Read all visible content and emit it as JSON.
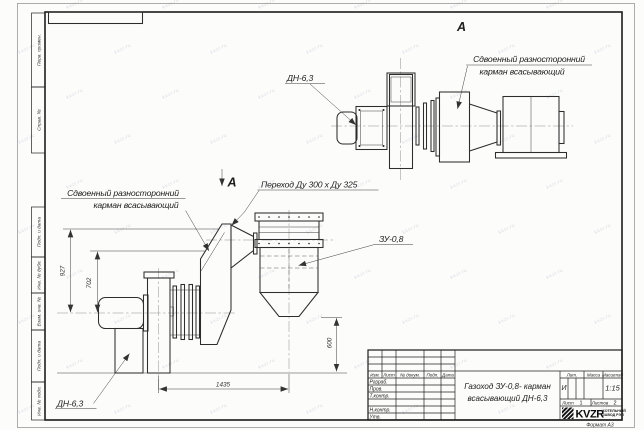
{
  "sheet": {
    "watermark_text": "kvzr.ru",
    "format_label": "Формат  А3"
  },
  "margin_stamps": {
    "top": [
      "Перв. примен.",
      "Справ. №"
    ],
    "bottom": [
      "Подп. и дата",
      "Инв. № дубл.",
      "Взам. инв. №",
      "Подп. и дата",
      "Инв. № подл."
    ]
  },
  "view_a": {
    "marker": "А",
    "fan_label": "ДН-6,3",
    "pocket_label_line1": "Сдвоенный разносторонний",
    "pocket_label_line2": "карман всасывающий"
  },
  "main_view": {
    "view_arrow_label": "А",
    "pocket_label_line1": "Сдвоенный разносторонний",
    "pocket_label_line2": "карман всасывающий",
    "transition_label": "Переход Ду  300 х  Ду 325",
    "collector_label": "ЗУ-0,8",
    "fan_label": "ДН-6,3",
    "dims": {
      "h927": "927",
      "h702": "702",
      "l1435": "1435",
      "h600": "600"
    }
  },
  "title_block": {
    "header": {
      "izm": "Изм.",
      "list": "Лист",
      "doc": "№ докум.",
      "podp": "Подп.",
      "data": "Дата"
    },
    "rows": {
      "razrab": "Разраб.",
      "prov": "Пров.",
      "tkontr": "Т.контр.",
      "nkontr": "Н.контр.",
      "utv": "Утв."
    },
    "title_line1": "Газоход ЗУ-0,8-  карман",
    "title_line2": "всасывающий ДН-6,3",
    "lit_label": "Лит.",
    "lit_value": "И",
    "mass_label": "Масса",
    "scale_label": "Масштаб",
    "scale_value": "1:15",
    "sheet_label": "Лист",
    "sheet_value": "1",
    "sheets_label": "Листов",
    "sheets_value": "2",
    "logo_text": "KVZR",
    "company_line1": "КОТЕЛЬНЫЙ",
    "company_line2": "ЗАВОД РЭП"
  }
}
